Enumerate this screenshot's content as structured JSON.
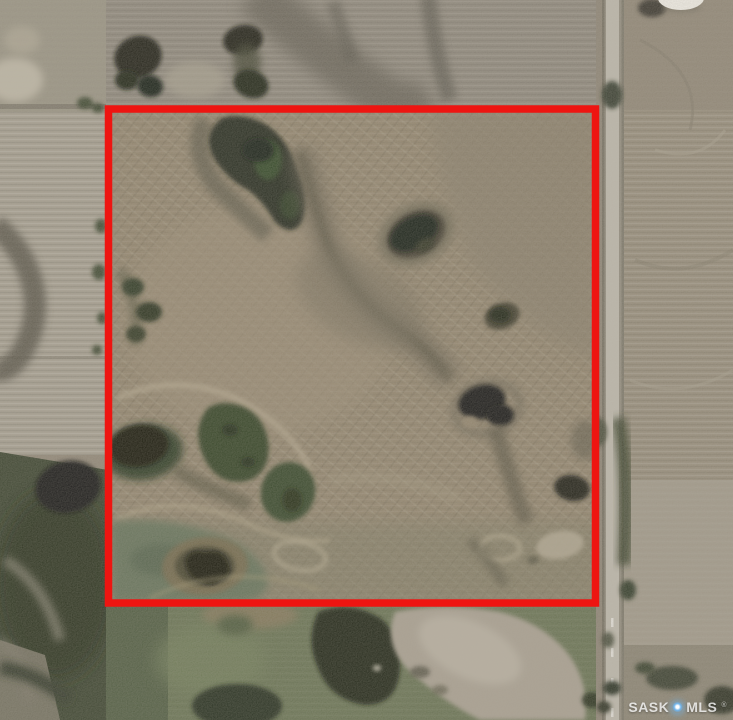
{
  "scene": {
    "kind": "aerial-satellite-photo",
    "subject": "farmland parcel outlined in red with gravel road on right",
    "colors": {
      "field_tan": "#8f8169",
      "field_gray": "#8b8478",
      "left_field_pale": "#a39c8d",
      "grass_green": "#636e4d",
      "wetland_dark": "#1c2312",
      "pond_black": "#0b0d07",
      "road_gray": "#bdb8ac",
      "pale_slough": "#a89f90",
      "white_cutoff": "#f4f1ea"
    }
  },
  "boundary": {
    "color": "#ee1511",
    "shape": "rectangle"
  },
  "watermark": {
    "prefix": "SASK",
    "suffix": "MLS",
    "registered": "®",
    "diamond_color": "#6fb4ec",
    "text_color": "rgba(255,255,255,0.78)"
  }
}
